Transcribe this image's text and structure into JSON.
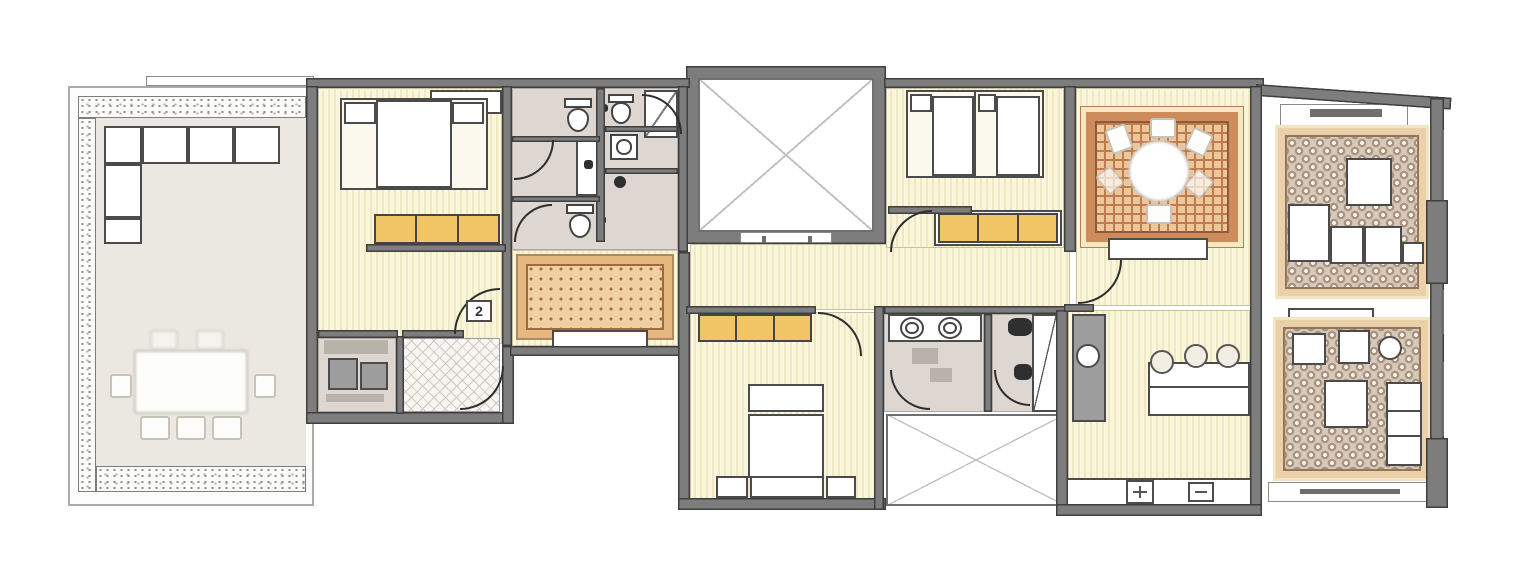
{
  "floor_plan": {
    "unit_label": "2",
    "rooms": [
      "terrace",
      "bedroom-1",
      "bathroom-1",
      "bathroom-2",
      "shower-room",
      "hall-rug-corridor",
      "lightwell-courtyard-1",
      "bedroom-2",
      "dining-room",
      "living-room-1",
      "entrance-hall",
      "utility-room",
      "bedroom-3",
      "bathroom-3-double-sink",
      "wc-room",
      "lightwell-courtyard-2",
      "kitchen",
      "living-room-2"
    ],
    "colors": {
      "wall": "#7d7d7d",
      "wall-stroke": "#3f3f3f",
      "stripe-a": "#faf6dc",
      "stripe-b": "#efe8c2",
      "bath-floor": "#ded6d0",
      "terrace-floor": "#ebe8e1",
      "bench": "#f1c566",
      "rug-tan": "#f0cfa2"
    }
  }
}
